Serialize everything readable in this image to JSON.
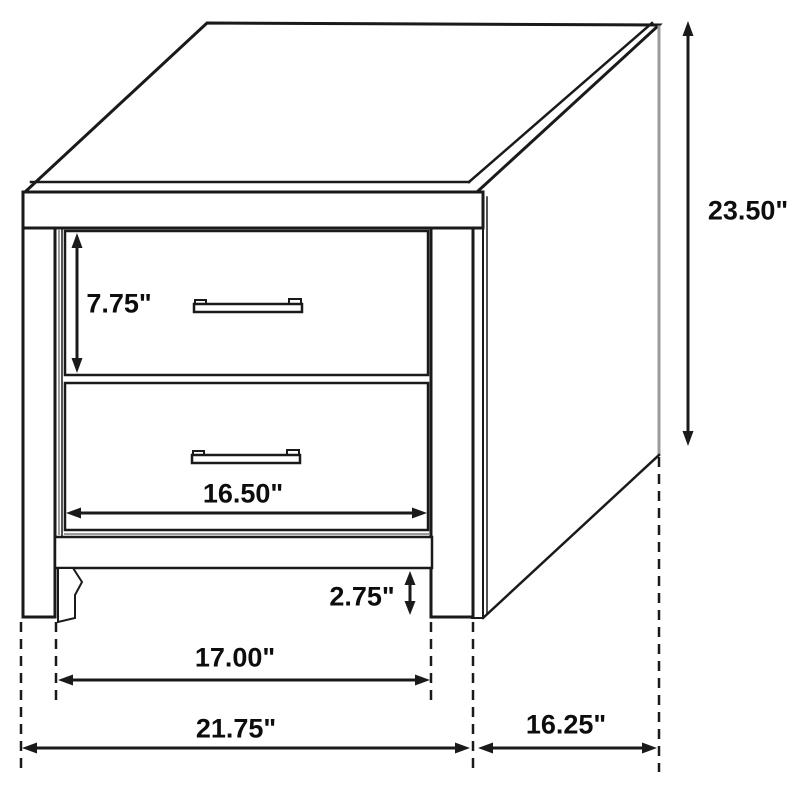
{
  "diagram": {
    "kind": "furniture-dimension-line-drawing",
    "object": {
      "name": "two-drawer nightstand",
      "drawer_count": 2
    },
    "units": "inches",
    "style": {
      "line_color": "#1a1a1a",
      "shaded_edge_color": "#9b9b9b",
      "background": "#ffffff",
      "label_color": "#0d0d0d"
    },
    "dimensions": {
      "drawer_front_height": {
        "label": "7.75\"",
        "value": 7.75,
        "orientation": "vertical"
      },
      "overall_height": {
        "label": "23.50\"",
        "value": 23.5,
        "orientation": "vertical"
      },
      "drawer_front_width": {
        "label": "16.50\"",
        "value": 16.5,
        "orientation": "horizontal"
      },
      "leg_clearance": {
        "label": "2.75\"",
        "value": 2.75,
        "orientation": "vertical"
      },
      "inner_leg_span": {
        "label": "17.00\"",
        "value": 17.0,
        "orientation": "horizontal"
      },
      "overall_width": {
        "label": "21.75\"",
        "value": 21.75,
        "orientation": "horizontal"
      },
      "overall_depth": {
        "label": "16.25\"",
        "value": 16.25,
        "orientation": "horizontal"
      }
    }
  }
}
